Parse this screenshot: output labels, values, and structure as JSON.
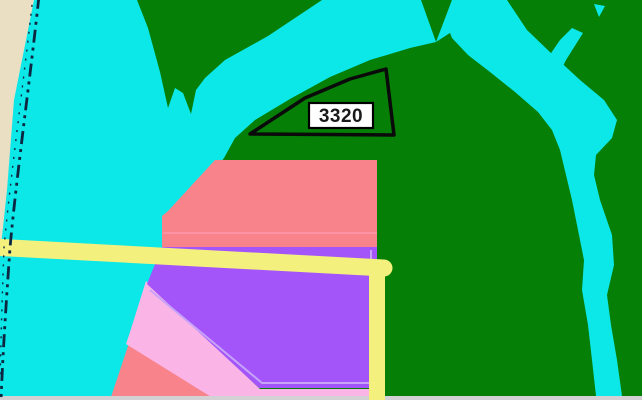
{
  "map": {
    "kind": "gis-zoning-parcel-map",
    "parcel_label": {
      "text": "3320"
    },
    "colors": {
      "water": "#0ce8e8",
      "land": "#067f06",
      "sheet": "#eadfc2",
      "boundary": "#0d2742",
      "zone_salmon": "#f8838a",
      "zone_purple": "#a355f9",
      "zone_pink": "#fab4e6",
      "road_yellow": "#f4f07e",
      "purple_inset": "#c7a3f8",
      "salmon_divider": "#fa9aae",
      "edge_strip": "#d4d1d4",
      "parcel_outline": "#0a0a0a",
      "label_bg": "#ffffff",
      "label_border": "#000000",
      "label_text": "#1a1a1a"
    }
  }
}
